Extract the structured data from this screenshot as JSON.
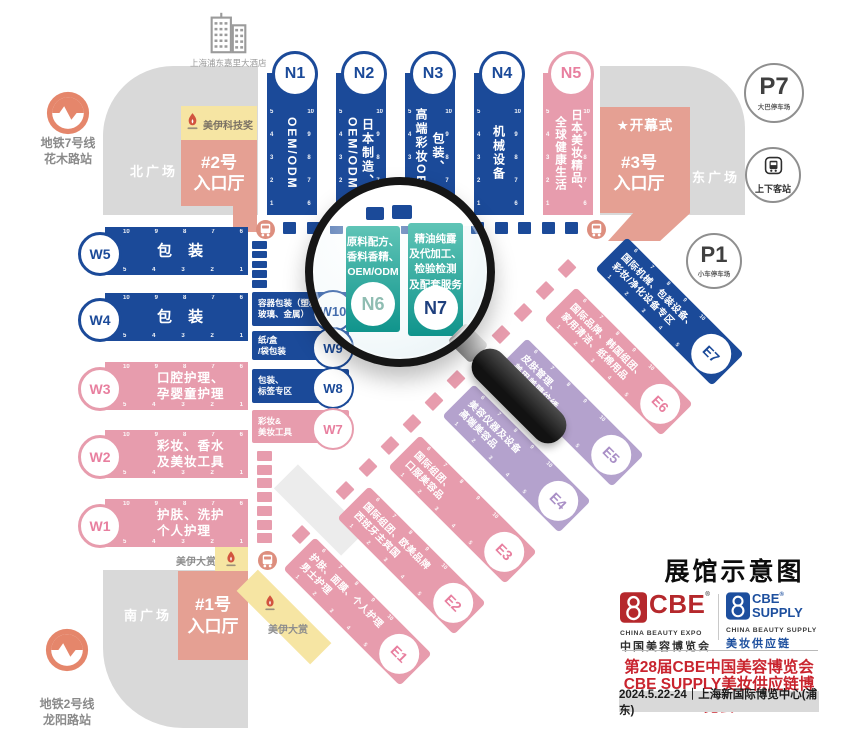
{
  "title": "展馆示意图",
  "colors": {
    "hall_blue": "#1b4a99",
    "hall_pink": "#e79cad",
    "hall_purple": "#b4a2cd",
    "entrance_salmon": "#e5a093",
    "plaza_gray": "#d9d9d9",
    "award_yellow": "#f6e5a3",
    "lens_teal": "#2ba49e",
    "metro_orange": "#e5866b",
    "cbe_red": "#b5282c",
    "cbe_blue": "#1d4f9e",
    "accent_red": "#c9242e"
  },
  "landmarks": {
    "hotel": "上海浦东嘉里大酒店",
    "metro7": "地铁7号线\n花木路站",
    "metro2": "地铁2号线\n龙阳路站",
    "north_plaza": "北广场",
    "south_plaza": "南广场",
    "east_plaza": "东广场",
    "entrance2": "#2号\n入口厅",
    "entrance3": "#3号\n入口厅",
    "entrance1": "#1号\n入口厅",
    "opening_ceremony": "★开幕式",
    "award_tech": "美伊科技奖",
    "award_grand_left": "美伊大赏",
    "award_grand_diag": "美伊大赏",
    "p7": {
      "code": "P7",
      "label": "大巴停车场"
    },
    "p1": {
      "code": "P1",
      "label": "小车停车场"
    },
    "dropoff": "上下客站"
  },
  "halls_n": [
    {
      "id": "N1",
      "label": "OEM/ODM"
    },
    {
      "id": "N2",
      "label": "日本制造、\nOEM/ODM"
    },
    {
      "id": "N3",
      "label": "包装、\n高端彩妆OEM"
    },
    {
      "id": "N4",
      "label": "机械设备"
    },
    {
      "id": "N5",
      "label": "日本美妆精品、\n全球健康生活"
    }
  ],
  "lens_halls": [
    {
      "id": "N6",
      "label": "原料配方、\n香料香精、\nOEM/ODM"
    },
    {
      "id": "N7",
      "label": "精油纯露\n及代加工、\n检验检测\n及配套服务"
    }
  ],
  "halls_w": [
    {
      "id": "W5",
      "label": "包 装"
    },
    {
      "id": "W4",
      "label": "包 装"
    },
    {
      "id": "W3",
      "label": "口腔护理、\n孕婴童护理"
    },
    {
      "id": "W2",
      "label": "彩妆、香水\n及美妆工具"
    },
    {
      "id": "W1",
      "label": "护肤、洗护\n个人护理"
    }
  ],
  "halls_w_side": [
    {
      "id": "W10",
      "label": "容器包装（塑料、\n玻璃、金属）"
    },
    {
      "id": "W9",
      "label": "纸/盒\n/袋包装"
    },
    {
      "id": "W8",
      "label": "包装、\n标签专区"
    },
    {
      "id": "W7",
      "label": "彩妆&\n美妆工具"
    }
  ],
  "halls_e": [
    {
      "id": "E1",
      "label": "护肤、面膜、个人护理\n男士护理"
    },
    {
      "id": "E2",
      "label": "国际组团、欧美品牌\n西班牙主宾国"
    },
    {
      "id": "E3",
      "label": "国际组团、\n口服美容品"
    },
    {
      "id": "E4",
      "label": "美容仪器及设备\n高端美容品"
    },
    {
      "id": "E5",
      "label": "皮肤管理、\n美甲美睫纹绣"
    },
    {
      "id": "E6",
      "label": "国际品牌、韩国组团、\n家用清洁、纸棉用品"
    },
    {
      "id": "E7",
      "label": "国际机械、包装设备、\n彩妆/净化设备专区"
    }
  ],
  "numbers": {
    "v_left": [
      "5",
      "4",
      "3",
      "2",
      "1"
    ],
    "v_right": [
      "10",
      "9",
      "8",
      "7",
      "6"
    ],
    "h_top": [
      "10",
      "9",
      "8",
      "7",
      "6"
    ],
    "h_bottom": [
      "5",
      "4",
      "3",
      "2",
      "1"
    ],
    "e_top": [
      "6",
      "7",
      "8",
      "9",
      "10"
    ],
    "e_bottom": [
      "1",
      "2",
      "3",
      "4",
      "5"
    ]
  },
  "decor": {
    "corridor_boxes": 13,
    "side_boxes": 5,
    "pink_column_boxes": 7,
    "diag_boxes": 13
  },
  "footer": {
    "reg": "®",
    "cbe": {
      "name": "CBE",
      "en": "CHINA BEAUTY EXPO",
      "cn": "中国美容博览会"
    },
    "cbe_supply": {
      "name": "CBE",
      "name2": "SUPPLY",
      "en": "CHINA BEAUTY SUPPLY",
      "cn": "美妆供应链"
    },
    "line1": "第28届CBE中国美容博览会",
    "line2": "CBE SUPPLY美妆供应链博览会",
    "date_venue": "2024.5.22-24｜上海新国际博览中心(浦东)"
  }
}
